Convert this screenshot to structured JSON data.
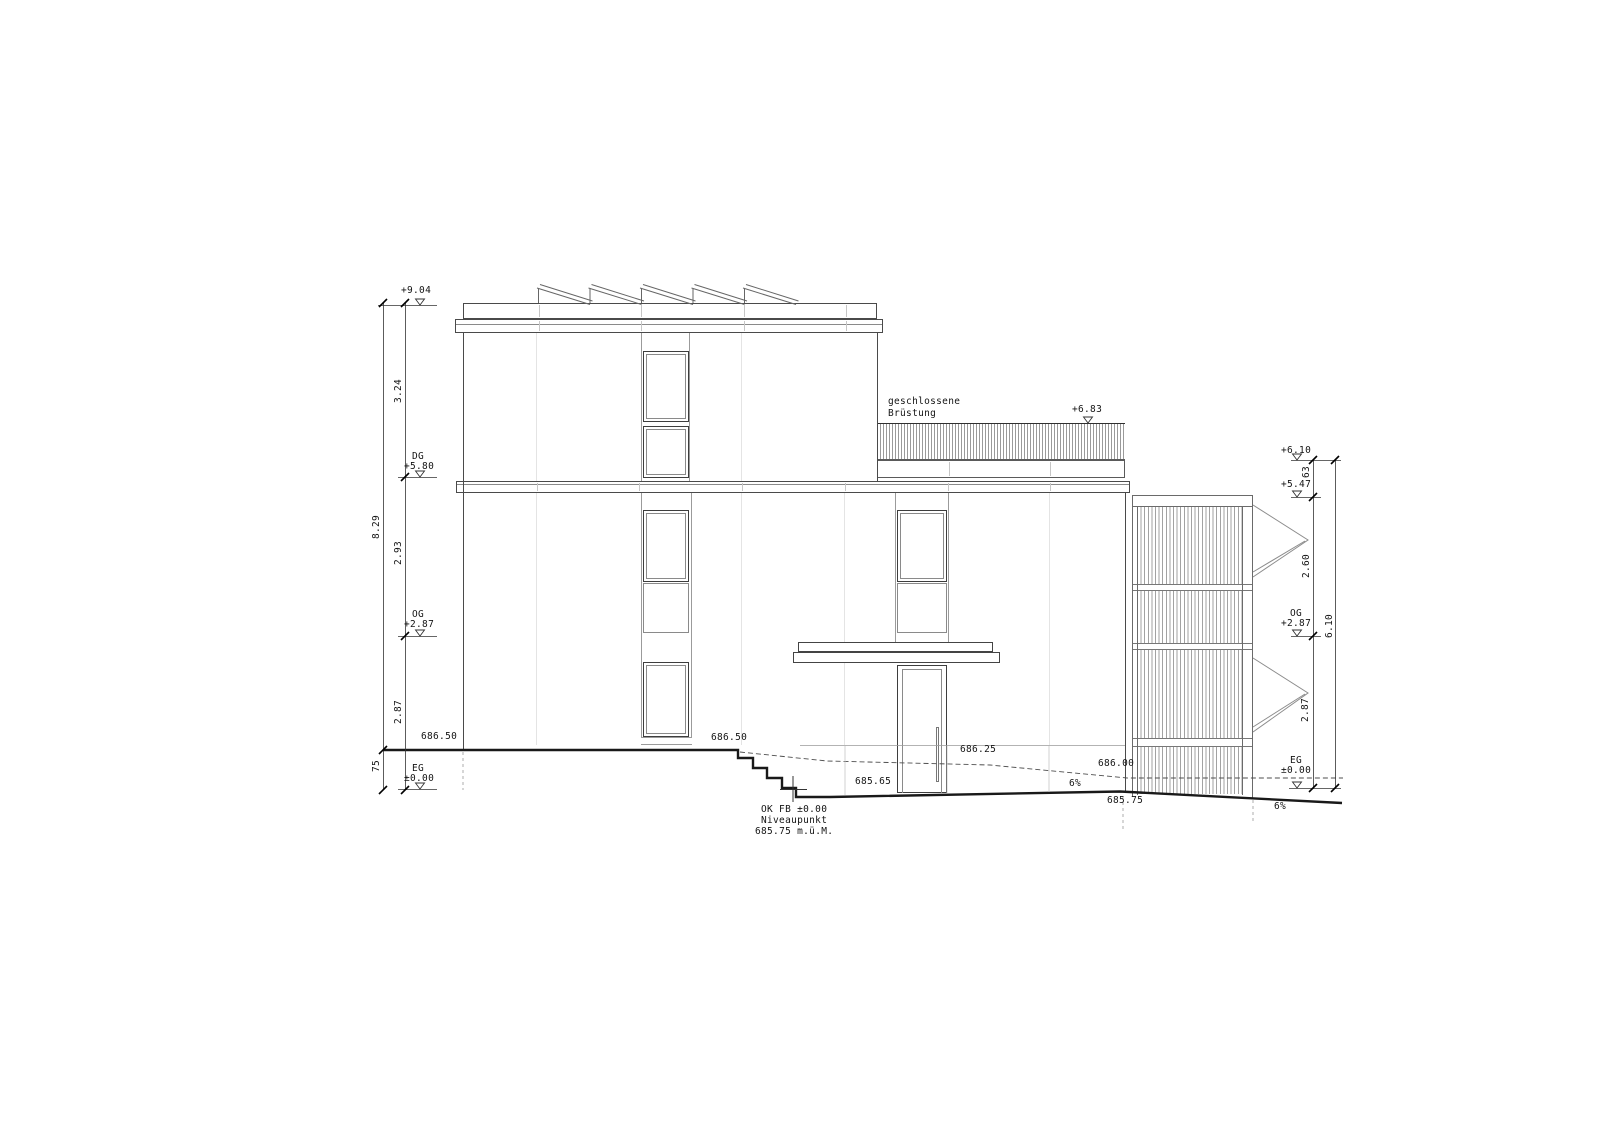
{
  "dimensions_left": {
    "total": "8.29",
    "seg_top": "3.24",
    "seg_mid": "2.93",
    "seg_bot": "2.87",
    "base": "75"
  },
  "levels_left": {
    "roof": "+9.04",
    "dg_label": "DG",
    "dg": "+5.80",
    "og_label": "OG",
    "og": "+2.87",
    "eg_label": "EG",
    "eg": "±0.00"
  },
  "dimensions_right": {
    "total": "6.10",
    "seg_top": "63",
    "seg_mid": "2.60",
    "seg_bot": "2.87"
  },
  "levels_right": {
    "top": "+6.10",
    "screen": "+5.47",
    "og_label": "OG",
    "og": "+2.87",
    "eg_label": "EG",
    "eg": "±0.00"
  },
  "parapet": {
    "line1": "geschlossene",
    "line2": "Brüstung",
    "level": "+6.83"
  },
  "terrain": {
    "left": "686.50",
    "steps": "686.50",
    "entry": "685.65",
    "mid": "686.25",
    "right": "686.00",
    "low": "685.75",
    "slope1": "6%",
    "slope2": "6%"
  },
  "datum": {
    "line1": "OK FB ±0.00",
    "line2": "Niveaupunkt",
    "line3": "685.75 m.ü.M."
  },
  "palette": {
    "line_dark": "#1a1a1a",
    "line_medium": "#555555",
    "hatch": "#9a9a9a"
  }
}
